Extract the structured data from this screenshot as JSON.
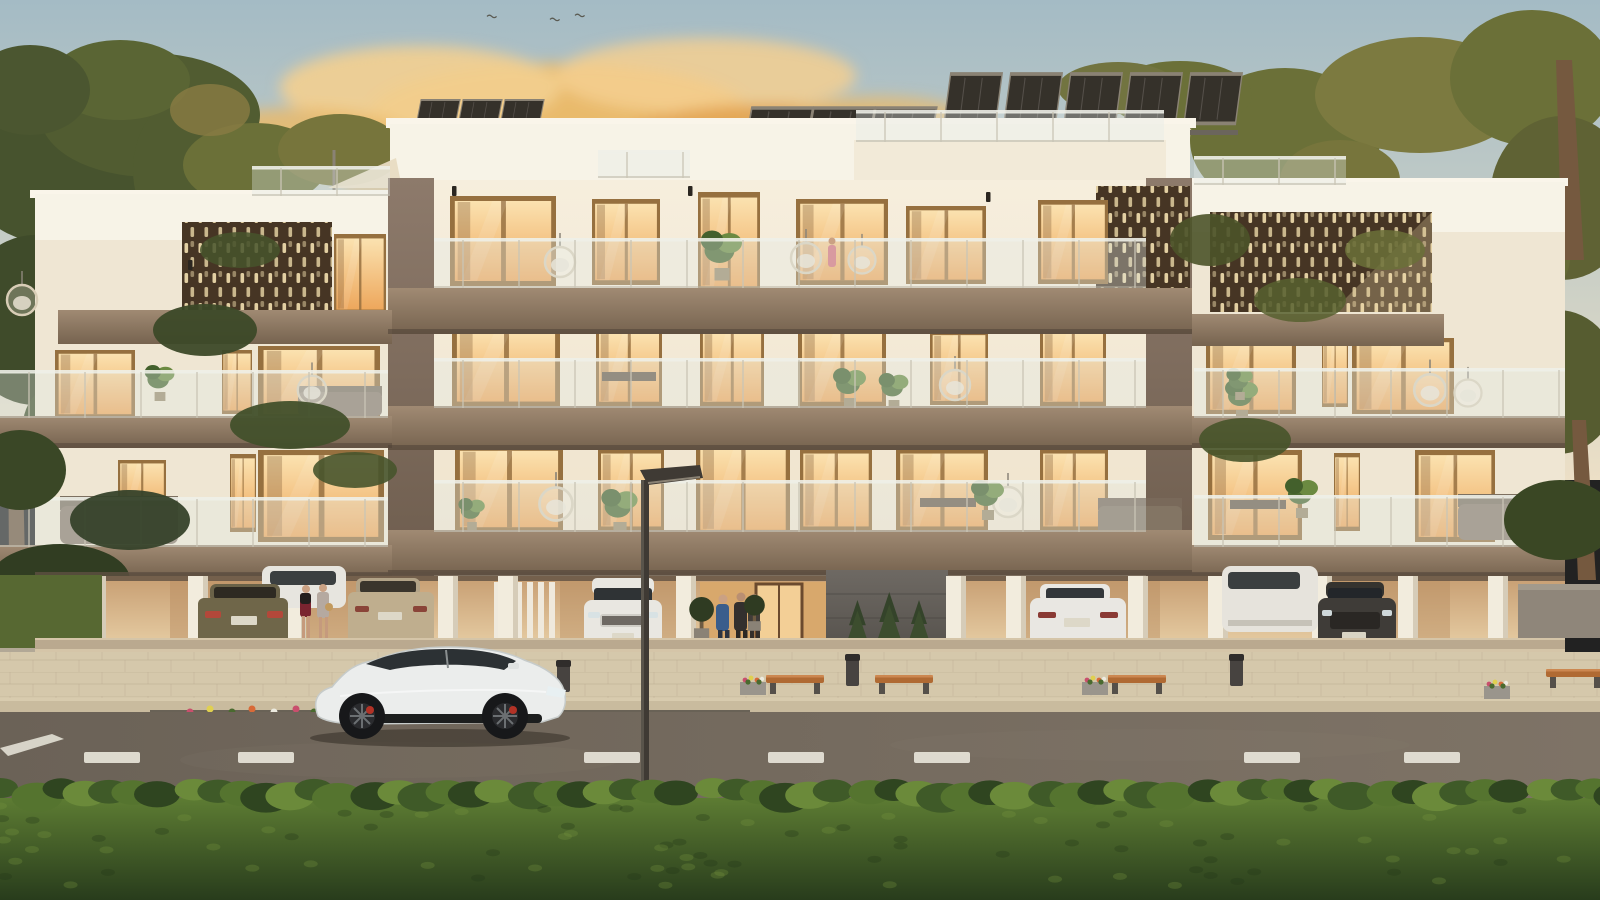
{
  "scene": {
    "setting": "Photorealistic dusk rendering of a modern three-storey apartment building with rooftop solar panels, warm-lit balconies, ground-level parking, street and trimmed hedge",
    "time_of_day": "dusk",
    "building": {
      "residential_floors": 3,
      "roof_features": [
        "solar-panels",
        "glass-balustrade",
        "shade-sail"
      ],
      "facade_features": [
        "white-render",
        "bronze-balcony-bands",
        "perforated-bronze-screens",
        "glass-balustrades",
        "floor-to-ceiling-glowing-windows",
        "hanging-egg-chairs",
        "balcony-plants"
      ]
    },
    "ground_level": {
      "parked_cars": [
        "olive sedan",
        "white suv",
        "beige sedan",
        "white sedan",
        "white sedan",
        "white suv",
        "dark suv"
      ],
      "people": [
        "man in blue suit at entrance",
        "two residents at entrance",
        "two women beside parked cars",
        "figure on top balcony"
      ],
      "entrance_features": [
        "dark stone feature wall",
        "conifer shrubs",
        "white flower bed",
        "topiary trees",
        "white picket screen"
      ]
    },
    "street": {
      "furniture": [
        "wooden benches",
        "litter bins",
        "flower planters",
        "street lamp"
      ],
      "parked_car": "white electric coupe with red brake calipers",
      "road_markings": [
        "dashed centre line",
        "white chevron"
      ],
      "foreground": "trimmed green hedge"
    },
    "vegetation": [
      "conifer trees left",
      "conifer trees right",
      "grass verge",
      "balcony greenery"
    ]
  },
  "palette": {
    "sky-top": "#a4bbc5",
    "sky-mid": "#c9cfc6",
    "sky-horizon": "#ecdfc6",
    "cloud-gold": "#ecb965",
    "cloud-light": "#f3cf90",
    "cloud-deep": "#e2a452",
    "cloud-shadow": "#b9b2a2",
    "wall-white": "#f6eedd",
    "wall-shade": "#efe3cc",
    "parapet": "#f7f3e7",
    "pier": "#8d7a6b",
    "pier-dark": "#6e5d4e",
    "slab-light": "#a08a73",
    "slab-dark": "#76634f",
    "frame": "#96703f",
    "glow-top": "#fbe2b0",
    "glow-bottom": "#eda75c",
    "screen-dark": "#463524",
    "screen-slot": "#ead7a8",
    "rail-top": "#eef0e8",
    "soffit": "#5f5042",
    "garage-top": "#c79e72",
    "garage-bottom": "#e8cfa6",
    "column": "#f2ecdd",
    "pavement": "#d5c8ab",
    "pavement-dark": "#c4b698",
    "curb": "#c9bb9e",
    "road-left": "#6b6257",
    "road-right": "#7e7366",
    "road-mark": "#eae7dc",
    "hedge-top": "#5d7c33",
    "hedge-bottom": "#283c1c",
    "tree-dark": "#3f4c2a",
    "tree-mid": "#55602f",
    "tree-warm": "#6b7038",
    "tree-gold": "#8a7c44",
    "trunk": "#75593f",
    "car-white": "#ebedec",
    "car-glass": "#2c3134",
    "caliper-red": "#b23226",
    "lamp": "#3f3a34",
    "bench-wood": "#b06a33",
    "topiary": "#2f3b22",
    "grass": "#576832",
    "flower-white": "#eceadf"
  }
}
